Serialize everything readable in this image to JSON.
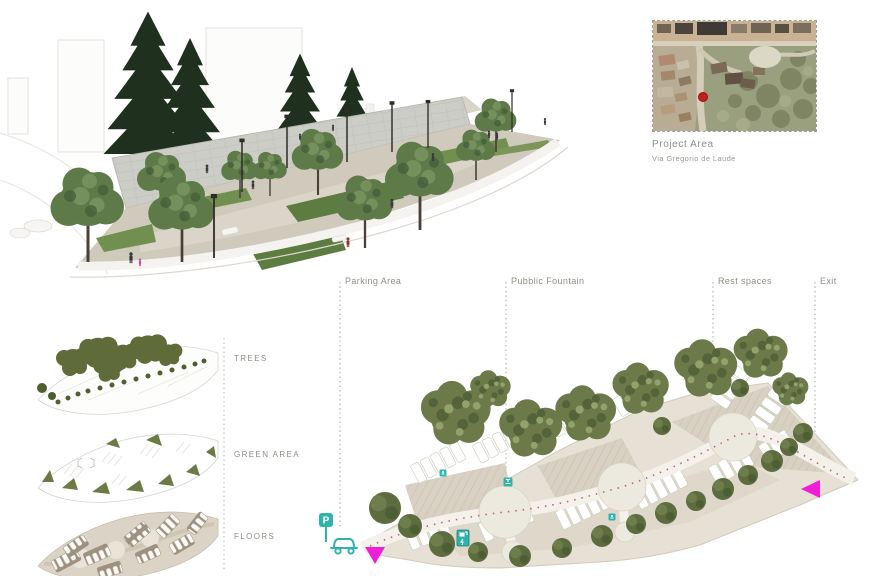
{
  "board": {
    "map_card": {
      "title": "Project Area",
      "subtitle": "Via Gregorio de Laude"
    },
    "site_plan": {
      "labels": {
        "parking_area": "Parking Area",
        "public_fountain": "Pubblic Fountain",
        "rest_spaces": "Rest spaces",
        "exit": "Exit"
      },
      "parking_sign_glyph": "P"
    },
    "layer_diagram": {
      "labels": [
        "TREES",
        "GREEN AREA",
        "FLOORS"
      ]
    },
    "colors": {
      "accent_teal": "#2fb3ab",
      "accent_magenta": "#ee1fd4",
      "marker_red": "#c41e1e",
      "canopy_green": "#6c7a49",
      "pine_green": "#20301f",
      "paving_beige": "#d8d0c1",
      "label_gray": "#8f8e85"
    }
  }
}
